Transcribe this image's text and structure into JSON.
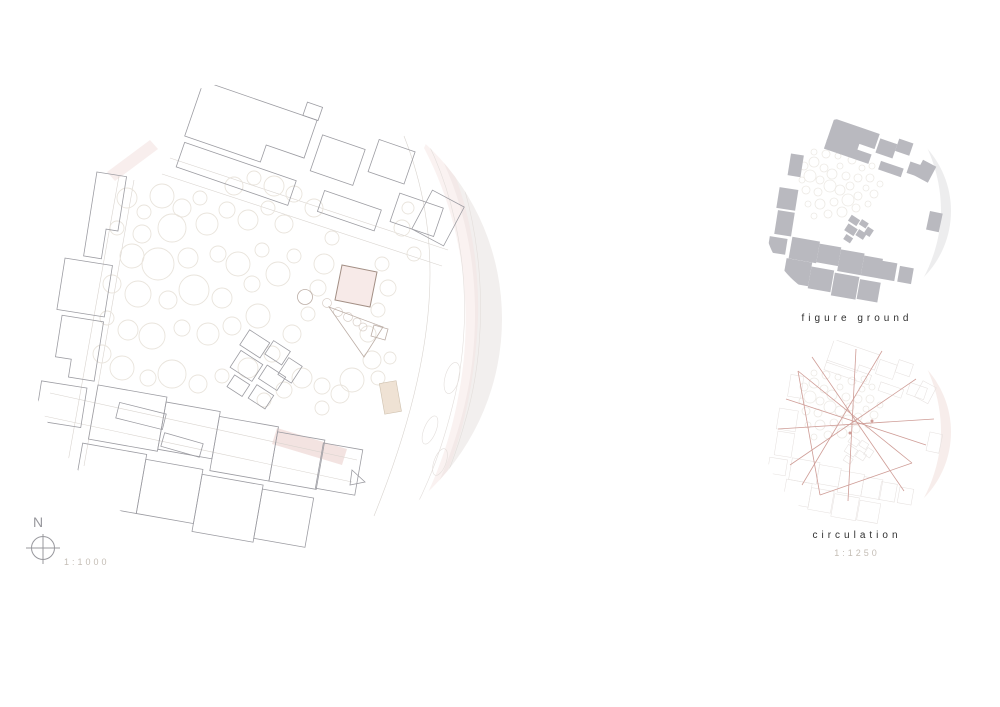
{
  "colors": {
    "background": "#ffffff",
    "building_outline": "#9c9ca2",
    "tree_outline": "#e9e4dc",
    "road_line": "#d9d4cf",
    "proposal_fill": "#f7eae8",
    "proposal_outline": "#a38f85",
    "pink_wash": "#f3e3e1",
    "river_fill": "#f2efee",
    "figure_ground_fill": "#b9b9bf",
    "circulation_line": "#cf9d97",
    "label_dark": "#2f2f2f",
    "label_light": "#c4bdb5",
    "compass_stroke": "#98989d"
  },
  "main_plan": {
    "north_label": "N",
    "scale_label": "1:1000"
  },
  "mini_maps": {
    "figure_ground": {
      "label": "figure ground"
    },
    "circulation": {
      "label": "circulation",
      "scale_label": "1:1250"
    }
  }
}
